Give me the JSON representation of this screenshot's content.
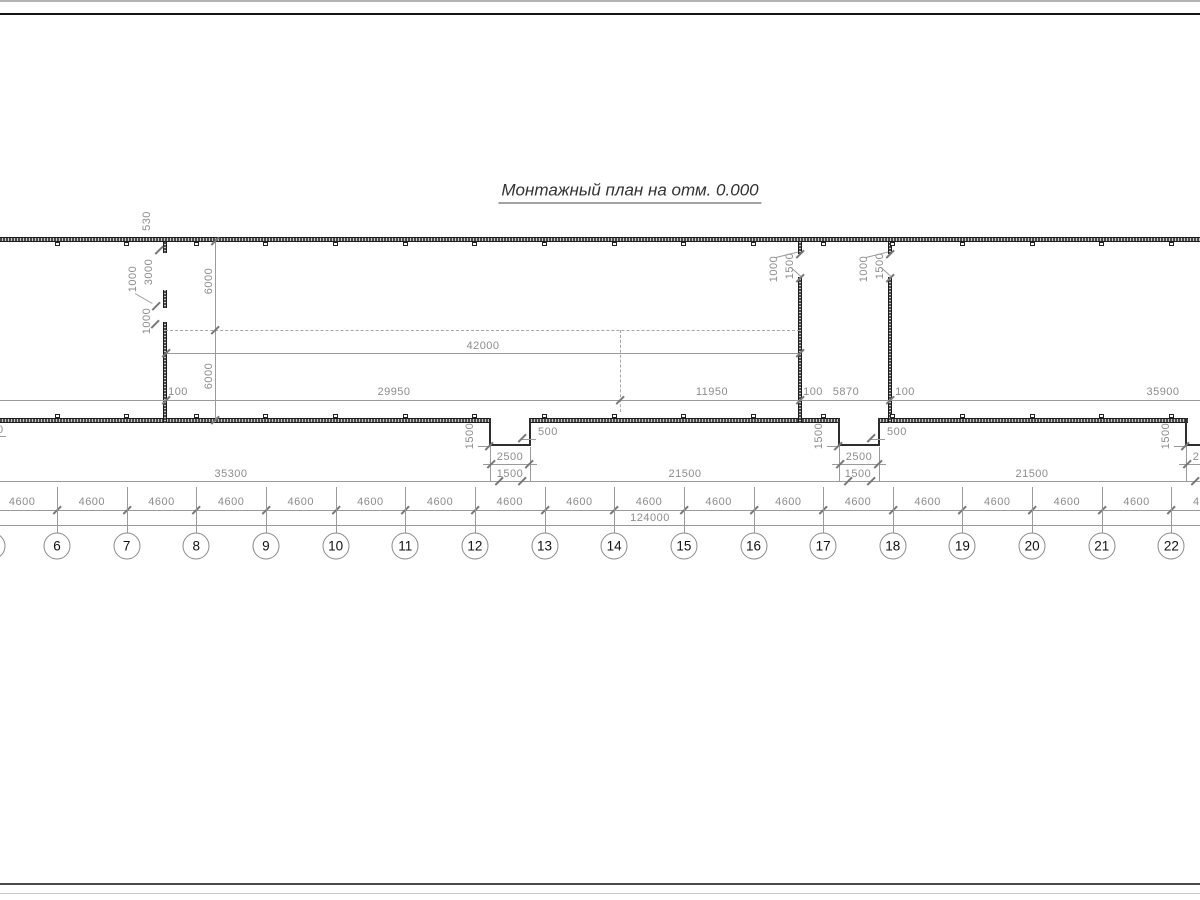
{
  "title": "Монтажный план на отм. 0.000",
  "colors": {
    "wall": "#2e2e2e",
    "dim_line": "#9a9a9a",
    "dim_text": "#8c8c8c",
    "title_text": "#333333"
  },
  "axes": {
    "labels": [
      "5",
      "6",
      "7",
      "8",
      "9",
      "10",
      "11",
      "12",
      "13",
      "14",
      "15",
      "16",
      "17",
      "18",
      "19",
      "20",
      "21",
      "22"
    ],
    "spacing_label": "4600",
    "total_label": "124000"
  },
  "row1_dims": [
    {
      "label": "100",
      "x": 178
    },
    {
      "label": "29950",
      "x": 394
    },
    {
      "label": "11950",
      "x": 712
    },
    {
      "label": "100",
      "x": 813
    },
    {
      "label": "5870",
      "x": 846
    },
    {
      "label": "100",
      "x": 905
    },
    {
      "label": "35900",
      "x": 1163
    }
  ],
  "row2_dims": [
    {
      "label": "35300",
      "x": 231
    },
    {
      "label": "1500",
      "x": 510
    },
    {
      "label": "21500",
      "x": 685
    },
    {
      "label": "1500",
      "x": 858
    },
    {
      "label": "21500",
      "x": 1032
    }
  ],
  "upper_dims": {
    "overall": "42000",
    "bay_upper": "6000",
    "bay_lower": "6000"
  },
  "left_wall_dims": {
    "d530": "530",
    "d1000a": "1000",
    "d3000": "3000",
    "d1000b": "1000"
  },
  "wall_openings": [
    {
      "x": 800,
      "stub": "1000",
      "opening": "1500"
    },
    {
      "x": 890,
      "stub": "1000",
      "opening": "1500"
    }
  ],
  "notches": [
    {
      "cx": 510,
      "width": "2500",
      "depth": "1500",
      "side": "500"
    },
    {
      "cx": 859,
      "width": "2500",
      "depth": "1500",
      "side": "500"
    },
    {
      "cx": 1206,
      "width": "2500",
      "depth": "1500"
    }
  ],
  "edge_label": "0"
}
